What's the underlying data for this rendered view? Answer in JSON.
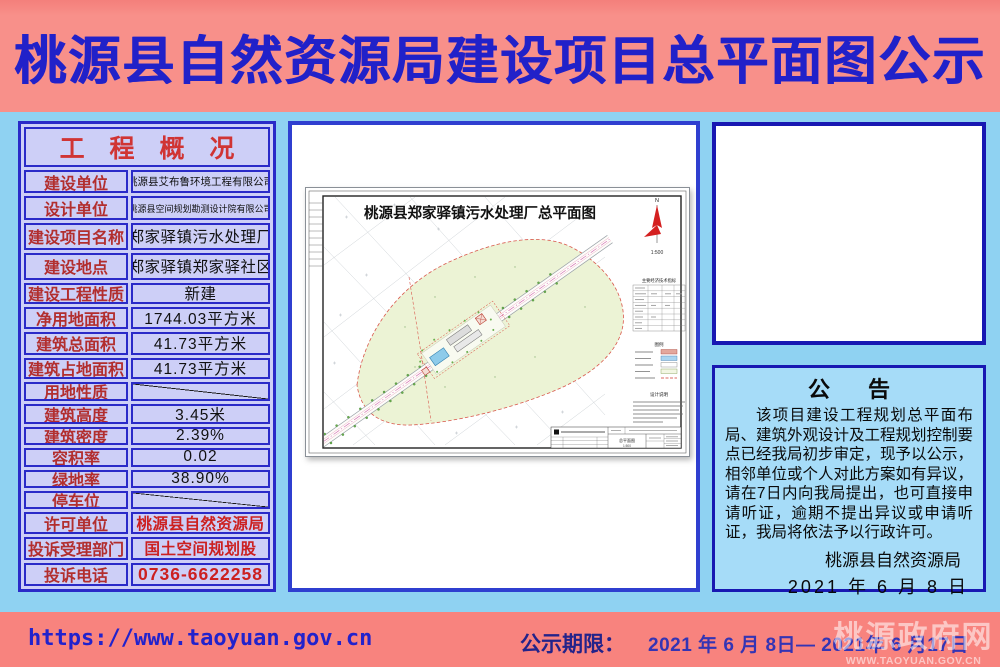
{
  "banner": {
    "title": "桃源县自然资源局建设项目总平面图公示"
  },
  "overview_table": {
    "header": "工 程 概 况",
    "rows": [
      {
        "label": "建设单位",
        "value": "桃源县艾布鲁环境工程有限公司"
      },
      {
        "label": "设计单位",
        "value": "桃源县空间规划勘测设计院有限公司"
      },
      {
        "label": "建设项目名称",
        "value": "郑家驿镇污水处理厂"
      },
      {
        "label": "建设地点",
        "value": "郑家驿镇郑家驿社区"
      },
      {
        "label": "建设工程性质",
        "value": "新建"
      },
      {
        "label": "净用地面积",
        "value": "1744.03平方米"
      },
      {
        "label": "建筑总面积",
        "value": "41.73平方米"
      },
      {
        "label": "建筑占地面积",
        "value": "41.73平方米"
      },
      {
        "label": "用地性质",
        "value": ""
      },
      {
        "label": "建筑高度",
        "value": "3.45米"
      },
      {
        "label": "建筑密度",
        "value": "2.39%"
      },
      {
        "label": "容积率",
        "value": "0.02"
      },
      {
        "label": "绿地率",
        "value": "38.90%"
      },
      {
        "label": "停车位",
        "value": ""
      },
      {
        "label": "许可单位",
        "value": "桃源县自然资源局"
      },
      {
        "label": "投诉受理部门",
        "value": "国土空间规划股"
      },
      {
        "label": "投诉电话",
        "value": "0736-6622258"
      }
    ]
  },
  "drawing": {
    "title": "桃源县郑家驿镇污水处理厂总平面图",
    "north": "N",
    "scale": "1:500",
    "indicators_title": "主要经济技术指标",
    "legend_title": "图例",
    "notes_title": "设计说明",
    "titleblock_name": "总平面图",
    "titleblock_scale": "1:500"
  },
  "notice": {
    "title": "公 告",
    "body": "该项目建设工程规划总平面布局、建筑外观设计及工程规划控制要点已经我局初步审定，现予以公示，相邻单位或个人对此方案如有异议，请在7日内向我局提出，也可直接申请听证，逾期不提出异议或申请听证，我局将依法予以行政许可。",
    "signature": "桃源县自然资源局",
    "date": "2021 年 6 月 8 日"
  },
  "footer": {
    "url": "https://www.taoyuan.gov.cn",
    "period_label": "公示期限：",
    "period_value": "2021 年 6 月 8日— 2021年 6 月17日",
    "watermark_line1": "桃源政府网",
    "watermark_line2": "WWW.TAOYUAN.GOV.CN"
  },
  "colors": {
    "page_bg": "#8FD2F2",
    "banner_bg": "#F8908A",
    "banner_text": "#2121C9",
    "table_bg": "#CDCFF7",
    "table_border": "#2A2AC8",
    "label_red": "#B22E2E",
    "header_red": "#D03434",
    "value_red": "#CC2020",
    "panel_border": "#2F3FD0",
    "box_border": "#1818B2",
    "notice_bg": "#A6DCF8",
    "footer_bg": "#F8837E",
    "url_blue": "#2222CC",
    "period_navy": "#23238A",
    "date_blue": "#3434B4",
    "site_green": "#ECF3D5",
    "boundary_red": "#D9574C"
  }
}
